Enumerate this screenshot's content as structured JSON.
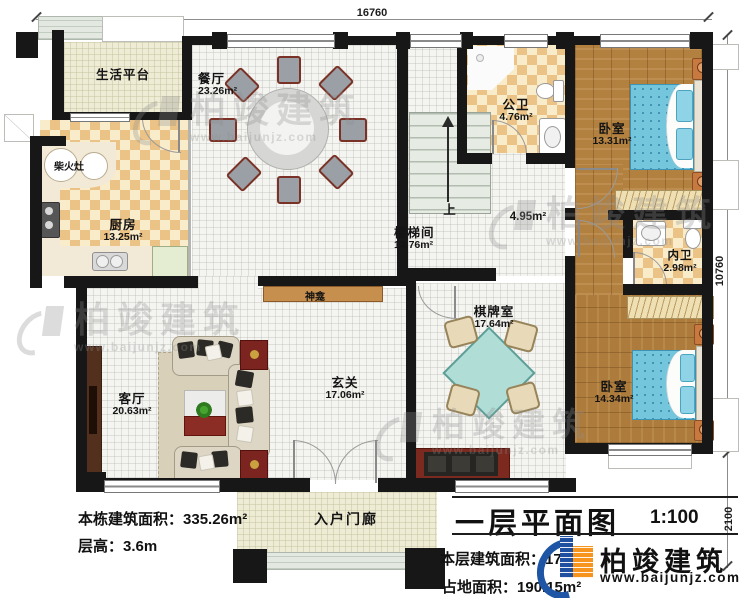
{
  "dimensions": {
    "top": "16760",
    "right_upper": "10760",
    "right_lower": "2100"
  },
  "rooms": {
    "life_platform": {
      "name": "生活平台"
    },
    "dining": {
      "name": "餐厅",
      "area": "23.26m²"
    },
    "kitchen": {
      "name": "厨房",
      "area": "13.25m²"
    },
    "wood_stove": {
      "name": "柴火灶"
    },
    "public_bath": {
      "name": "公卫",
      "area": "4.76m²"
    },
    "bedroom_top": {
      "name": "卧室",
      "area": "13.31m²"
    },
    "stairwell": {
      "name": "楼梯间",
      "area": "13.76m²",
      "up": "上"
    },
    "hallway": {
      "area": "4.95m²"
    },
    "inner_bath": {
      "name": "内卫",
      "area": "2.98m²"
    },
    "bedroom_bottom": {
      "name": "卧室",
      "area": "14.34m²"
    },
    "chess_room": {
      "name": "棋牌室",
      "area": "17.64m²"
    },
    "shrine": {
      "name": "神龛"
    },
    "foyer": {
      "name": "玄关",
      "area": "17.06m²"
    },
    "living_room": {
      "name": "客厅",
      "area": "20.63m²"
    },
    "entry_porch": {
      "name": "入户门廊"
    }
  },
  "annotations": {
    "total_building_area_label": "本栋建筑面积：",
    "total_building_area_value": "335.26m²",
    "floor_height_label": "层高：",
    "floor_height_value": "3.6m",
    "floor_area_label": "本层建筑面积：",
    "floor_area_value": "174",
    "site_area_label": "占地面积：",
    "site_area_value": "190.15m²"
  },
  "title": {
    "text": "一层平面图",
    "scale": "1:100"
  },
  "brand": {
    "name": "柏竣建筑",
    "url": "www.baijunjz.com"
  },
  "watermark": {
    "text": "柏竣建筑",
    "url": "www.baijunjz.com"
  },
  "colors": {
    "wall": "#171717",
    "tile_light": "#f9ecca",
    "tile_dark": "#ecc386",
    "wood_floor": "#b2803f",
    "bed": "#74c6dc",
    "accent_red": "#7c241f",
    "brand_blue": "#1f55a5",
    "brand_orange": "#f7941d"
  }
}
